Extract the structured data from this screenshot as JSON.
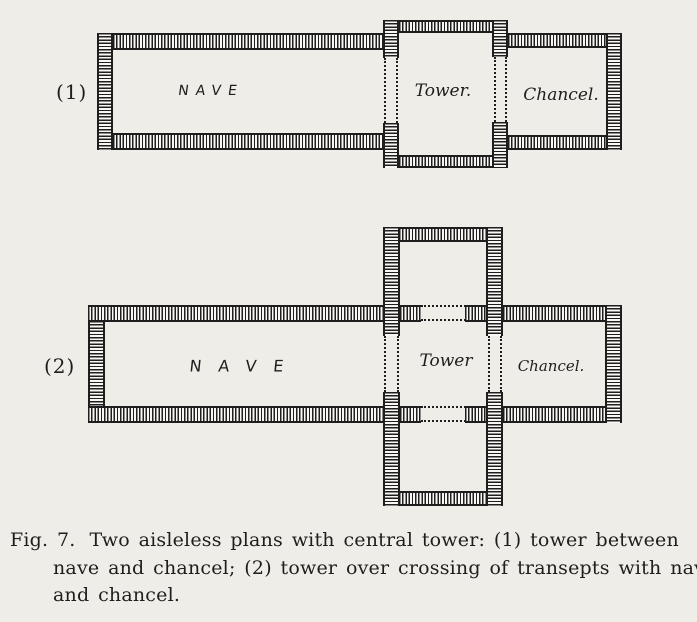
{
  "colors": {
    "paper": "#efede8",
    "ink": "#1e1e1e",
    "wallfill": "#f8f7f3"
  },
  "plan1": {
    "index_label": "(1)",
    "nave_label": "NAVE",
    "tower_label": "Tower.",
    "chancel_label": "Chancel."
  },
  "plan2": {
    "index_label": "(2)",
    "nave_label": "NAVE",
    "tower_label": "Tower",
    "chancel_label": "Chancel."
  },
  "caption": {
    "fig_label": "Fig. 7.",
    "line1_rest": "Two aisleless plans with central tower: (1) tower between",
    "line2": "nave and chancel; (2) tower over crossing of transepts with nave",
    "line3": "and chancel."
  }
}
